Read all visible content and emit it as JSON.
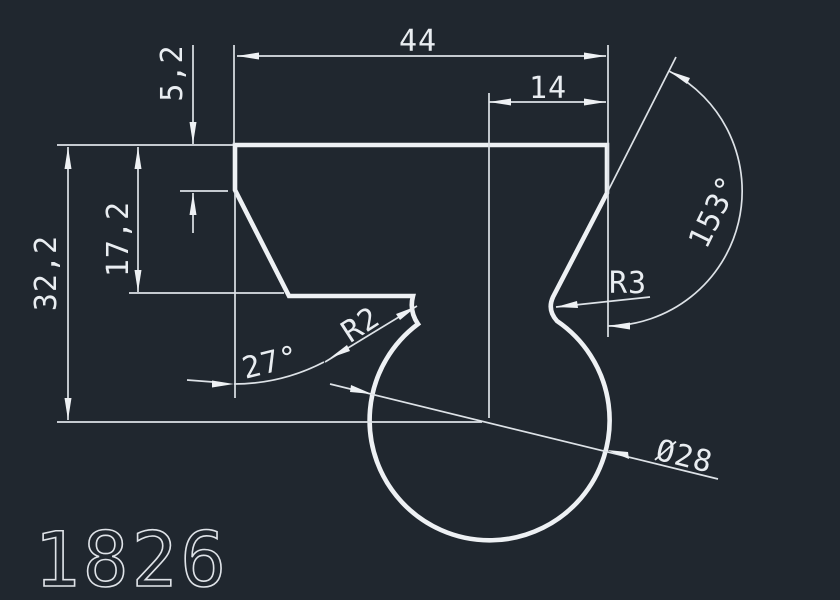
{
  "drawing": {
    "part_number": "1826",
    "labels": {
      "width_top": "44",
      "width_offset": "14",
      "height_step": "5,2",
      "height_mid": "17,2",
      "height_total": "32,2",
      "angle_chamfer": "27°",
      "radius_left_fillet": "R2",
      "radius_right_fillet": "R3",
      "angle_open": "153°",
      "diameter_circle": "Ø28"
    },
    "colors": {
      "background": "#20272f",
      "lines": "#eef1f4"
    }
  }
}
